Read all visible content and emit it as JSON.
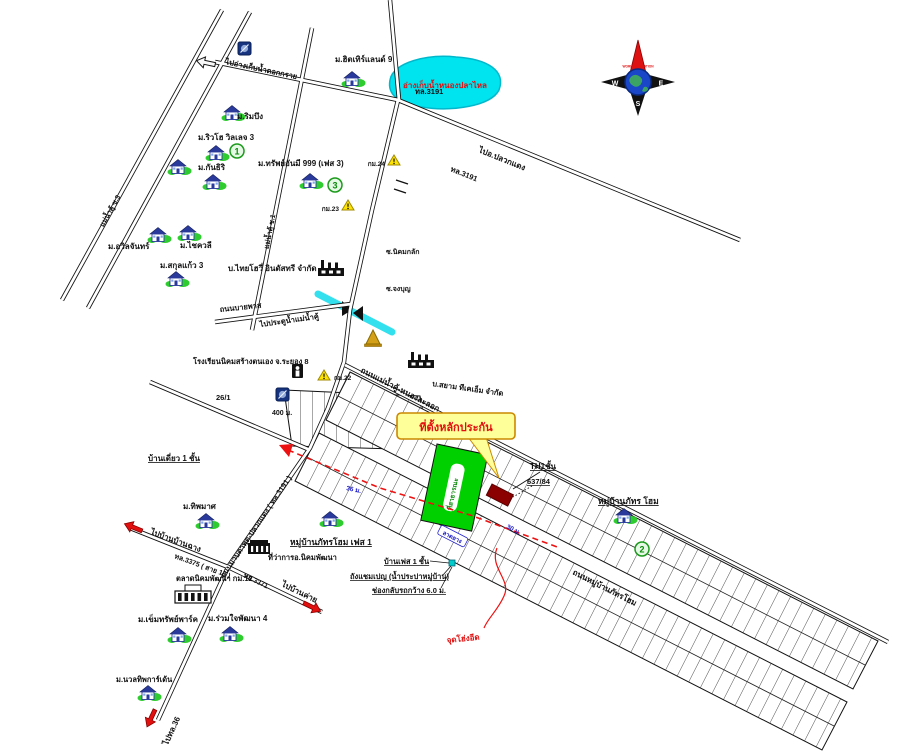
{
  "map_type": "hand-drawn location sketch map (collateral site map, Thailand)",
  "colors": {
    "pond_fill": "#00e4f0",
    "pond_edge": "#00b8cc",
    "highlight_box": "#ffff99",
    "highlight_border": "#cc8800",
    "collateral_plot": "#8b0000",
    "public_block": "#00d000",
    "route_dashed": "#ee1111",
    "red_text": "#e01010",
    "blue_note": "#1818c8",
    "road_casing": "#111111",
    "compass_north": "#dd1111",
    "globe": "#1a46c8"
  },
  "compass": {
    "n": "N",
    "e": "E",
    "s": "S",
    "w": "W",
    "brand": "WORLD VALUATION"
  },
  "labels": {
    "pond": "อ่างเก็บน้ำหนองปลาไหล",
    "to_dokkrai": "ไปอ่างเก็บน้ำดอกกราย",
    "hw3191_a": "ทล.3191",
    "hw3191_b": "ทล.3191",
    "to_pluakdaeng": "ไปอ.ปลวกแดง",
    "soi3": "แม่น้ำคู้ ซ.3",
    "soi1": "แม่น้ำคู้ ซ.1",
    "km24": "กม.24",
    "km23": "กม.23",
    "km22": "กม.22",
    "m_rimbueng": "ม.ริมบึง",
    "m_riverho": "ม.ริวโฮ วิลเลจ 3",
    "m_kanthiri": "ม.กันธิริ",
    "m_hitherland": "ม.ฮิตเทิร์แลนด์ 9",
    "m_sap999": "ม.ทรัพย์อันมี 999 (เฟส 3)",
    "m_awin": "ม.อวิลจันทร์",
    "m_chaikhwali": "ม.ไชควลี",
    "m_sakulkaew": "ม.สกุลแก้ว 3",
    "thaihowi": "บ.ไทยโฮวี่ อินดัสทรี จำกัด",
    "soi_nikhomklak": "ซ.นิคมกลัก",
    "soi_jongbun": "ซ.จงบุญ",
    "bypass": "ถนนบายพาส",
    "watergate": "ไปประตูน้ำแม่น้ำคู้",
    "school8": "โรงเรียนนิคมสร้างตนเอง จ.ระยอง 8",
    "maenamkhu_rd": "ถนนแม่น้ำคู้-หนองละลอก",
    "siam_tkm": "บ.สยาม ทีเคเอ็ม จำกัด",
    "no26_1": "26/1",
    "d400": "400 ม.",
    "single_house": "บ้านเดี่ยว 1 ชั้น",
    "collateral": "ที่ตั้งหลักประกัน",
    "public_land": "ที่สาธารณะ",
    "th1": "TH1ชั้น",
    "house_no": "637/84",
    "pathom_home": "หมู่บ้านภัทร โฮม",
    "pathom_home_ph1": "หมู่บ้านภัทรโฮม เฟส 1",
    "d36": "36 ม.",
    "d30": "30 ม.",
    "surface": "ลาดยาง",
    "phase1": "บ้านเฟส 1 ชั้น",
    "tank": "ถังแชมเปญ (น้ำประปาหมู่บ้าน)",
    "uturn": "ช่องกลับรถกว้าง 6.0 ม.",
    "pathome_rd": "ถนนหมู่บ้านภัทรโฮม",
    "hong_eed": "จุดโฮ่งอีด",
    "maptaphut_rd": "ถนนมาบตาพุด-ปลวกแดง ( ทล.3191 )",
    "m_tipamas": "ม.ทิพมาศ",
    "to_banchang": "ไปบ้านบ้านฉาง",
    "hw3375": "ทล.3375 ( สาย 13 )",
    "market": "ตลาดนิคมพัฒนา กม.12",
    "district": "ที่ว่าการอ.นิคมพัฒนา",
    "hw3371": "ทล.3371",
    "to_bankhai": "ไปบ้านค่าย",
    "m_khemsap": "ม.เข็มทรัพย์พาร์ค",
    "m_ruamjai": "ม.ร่วมใจพัฒนา 4",
    "m_nuanthip": "ม.นวลทิพการ์เด้น",
    "to_hw36": "ไปทล.36",
    "n1": "1",
    "n2": "2",
    "n3": "3"
  }
}
